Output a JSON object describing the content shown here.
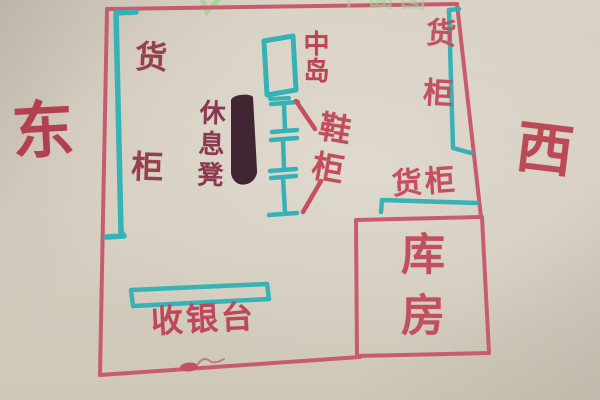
{
  "labels": {
    "east": "东",
    "west": "西",
    "left_shelf": "货柜",
    "right_shelf": "货柜",
    "mid_shelf": "货柜",
    "center_island": "中岛",
    "shoe_rack": "鞋柜",
    "rest_bench": "休息凳",
    "cashier": "收银台",
    "storeroom": "库房",
    "top_title_partial": "平面图"
  },
  "colors": {
    "red_marker_walls": "#c85c6d",
    "red_marker_text": "#bd4754",
    "dark_red_text": "#97404b",
    "teal_marker": "#2eb0b4",
    "bench_ink": "#3a1d2c",
    "green_marker": "#a4d19c",
    "paper": "#d6cfc1"
  },
  "legend": {
    "drawing_type": "hand-drawn shop floor plan",
    "orientation_left": "east",
    "orientation_right": "west"
  }
}
